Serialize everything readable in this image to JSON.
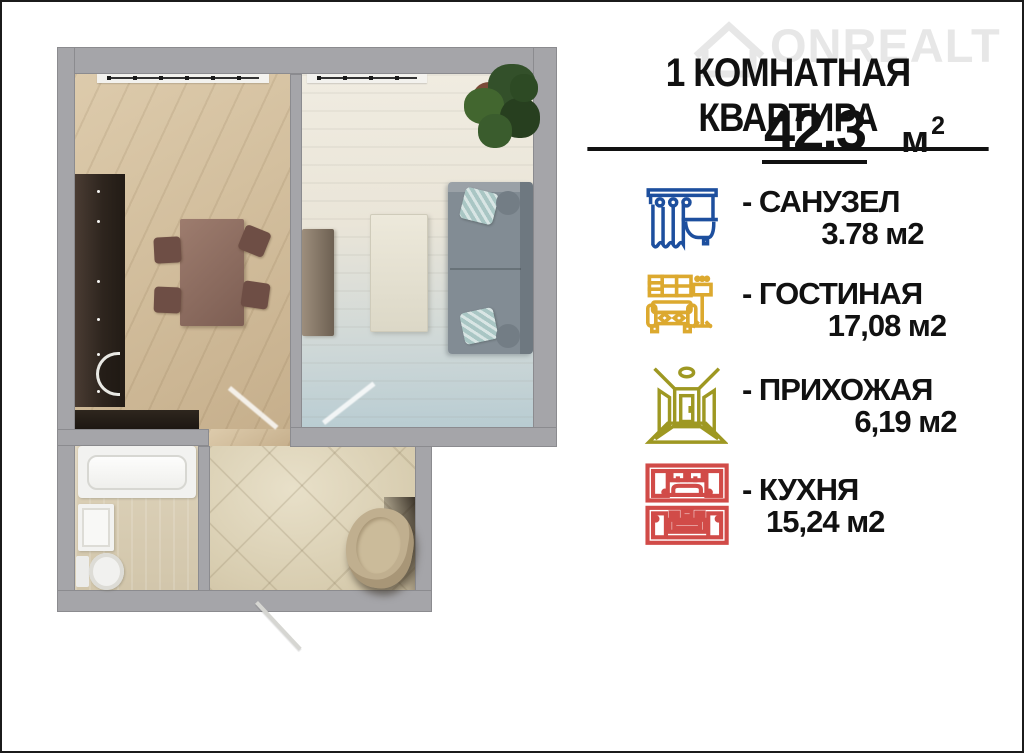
{
  "header": {
    "title": "1 КОМНАТНАЯ КВАРТИРА",
    "area_value": "42.3",
    "area_unit": "м",
    "area_exponent": "2"
  },
  "watermark": {
    "brand": "ONREALT"
  },
  "legend": {
    "items": [
      {
        "name": "- САНУЗЕЛ",
        "area": "3.78 м2",
        "color": "#1d4f9e",
        "icon": "bathtub-icon"
      },
      {
        "name": "- ГОСТИНАЯ",
        "area": "17,08 м2",
        "color": "#dca92f",
        "icon": "sofa-icon"
      },
      {
        "name": "- ПРИХОЖАЯ",
        "area": "6,19 м2",
        "color": "#9e9822",
        "icon": "hallway-icon"
      },
      {
        "name": "- КУХНЯ",
        "area": "15,24 м2",
        "color": "#d14b48",
        "icon": "kitchen-icon"
      }
    ]
  }
}
